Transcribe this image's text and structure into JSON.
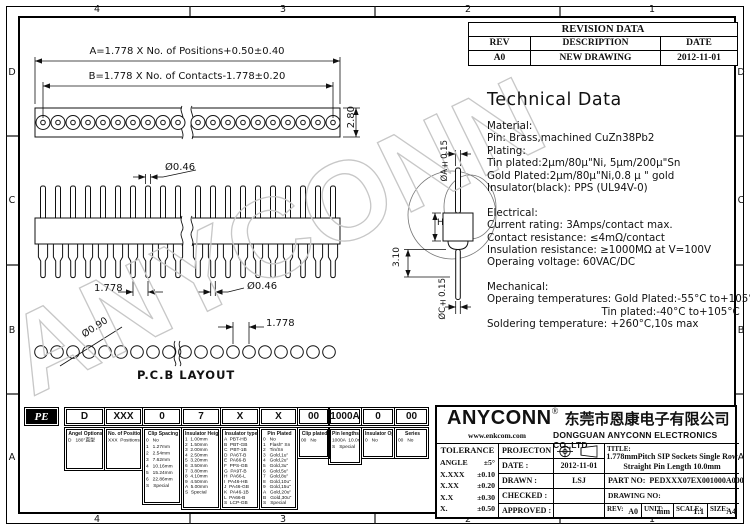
{
  "zones": {
    "cols": [
      "4",
      "3",
      "2",
      "1"
    ],
    "rows": [
      "D",
      "C",
      "B",
      "A"
    ]
  },
  "revision_table": {
    "title": "REVISION DATA",
    "headers": [
      "REV",
      "DESCRIPTION",
      "DATE"
    ],
    "rows": [
      [
        "A0",
        "NEW DRAWING",
        "2012-11-01"
      ]
    ]
  },
  "watermark": {
    "text": "ANYCONN"
  },
  "dims": {
    "a_label": "A=1.778 X No. of Positions+0.50±0.40",
    "b_label": "B=1.778 X No. of Contacts-1.778±0.20",
    "height_280": "2.80",
    "pin_dia_top": "Ø0.46",
    "pitch_side": "1.778",
    "pin_dia_bottom": "Ø0.46",
    "body_h": "H",
    "oa": "ØA±0.15",
    "tail_310": "3.10",
    "oc": "ØC±0.15",
    "hole_dia": "Ø0.90",
    "pitch_pcb": "1.778",
    "pcb_label": "P.C.B LAYOUT"
  },
  "tech": {
    "title": "Technical Data",
    "lines": [
      "Material:",
      "Pin: Brass,machined CuZn38Pb2",
      "Plating:",
      "Tin plated:2μm/80μ\"Ni, 5μm/200μ\"Sn",
      "Gold Plated:2μm/80μ\"Ni,0.8 μ \" gold",
      "Insulator(black): PPS (UL94V-0)",
      "",
      "Electrical:",
      "Current rating: 3Amps/contact max.",
      "Contact resistance: ≤4mΩ/contact",
      "Insulation resistance: ≥1000MΩ at V=100V",
      "Operaing voltage: 60VAC/DC",
      "",
      "Mechanical:",
      "Operaing temperatures: Gold Plated:-55°C to+105°C",
      "                                   Tin plated:-40°C to+105°C",
      "Soldering temperature: +260°C,10s max"
    ]
  },
  "ordering": {
    "prefix": "PE",
    "codes": [
      "D",
      "XXX",
      "0",
      "7",
      "X",
      "X",
      "00",
      "1000A",
      "0",
      "00"
    ],
    "boxes": [
      {
        "title": "Angel Options",
        "rows": [
          "D   180°直型"
        ]
      },
      {
        "title": "No. of Positions",
        "rows": [
          "XXX  Positions"
        ]
      },
      {
        "title": "Clip Spacing",
        "rows": [
          "0   No",
          "1   1.27mm",
          "2   2.54mm",
          "3   7.62mm",
          "4   10.16mm",
          "5   15.24mm",
          "6   22.86mm",
          "S   Special"
        ]
      },
      {
        "title": "Insulator Height",
        "rows": [
          "1  1.00mm",
          "2  1.50mm",
          "3  2.00mm",
          "4  2.50mm",
          "5  3.20mm",
          "6  3.50mm",
          "7  3.80mm",
          "8  4.10mm",
          "9  4.50mm",
          "A  5.00mm",
          "S  Special"
        ]
      },
      {
        "title": "Insulator type",
        "rows": [
          "A  PBT-HB",
          "B  PBT-GB",
          "C  PBT-1B",
          "D  PA6T-B",
          "E  PA66-B",
          "F  PPS-GB",
          "G  PA9T-B",
          "H  PA66-L",
          "I  PA46-HB",
          "J  PA46-GB",
          "K  PA46-1B",
          "L  PA66-B",
          "S  LCP-GB"
        ]
      },
      {
        "title": "Pin Plated",
        "rows": [
          "0   No",
          "1   Flash\" Sn",
          "2   Tin/Sn",
          "3   Gold,1u\"",
          "4   Gold,2u\"",
          "5   Gold,3u\"",
          "6   Gold,5u\"",
          "7   Gold,8u\"",
          "8   Gold,10u\"",
          "9   Gold,15u\"",
          "A   Gold,20u\"",
          "B   Gold,30u\"",
          "S   Special"
        ]
      },
      {
        "title": "Clip plated",
        "rows": [
          "00   No"
        ]
      },
      {
        "title": "Pin lengths(mm)",
        "rows": [
          "1000A  10.0mm",
          "S   Special"
        ]
      },
      {
        "title": "Insulator Option",
        "rows": [
          "0   No"
        ]
      },
      {
        "title": "Series",
        "rows": [
          "00   No"
        ]
      }
    ]
  },
  "company": {
    "logo": "ANYCONN",
    "reg": "®",
    "cn": "东莞市恩康电子有限公司",
    "web": "www.enkcom.com",
    "en": "DONGGUAN  ANYCONN  ELECTRONICS  CO.,LTD"
  },
  "tolerance": {
    "title": "TOLERANCE",
    "rows": [
      [
        "ANGLE",
        "±5°"
      ],
      [
        "X.XXX",
        "±0.10"
      ],
      [
        "X.XX",
        "±0.20"
      ],
      [
        "X.X",
        "±0.30"
      ],
      [
        "X.",
        "±0.50"
      ]
    ]
  },
  "approval": {
    "projection_label": "PROJECTON",
    "rows": [
      {
        "label": "DATE :",
        "value": "2012-11-01"
      },
      {
        "label": "DRAWN :",
        "value": "LSJ"
      },
      {
        "label": "CHECKED :",
        "value": ""
      },
      {
        "label": "APPROVED :",
        "value": ""
      }
    ]
  },
  "title_block": {
    "title_label": "TITLE:",
    "title_line1": "1.778mmPitch SIP Sockets Single Row",
    "title_line2": "Straight Pin Length 10.0mm",
    "part_label": "PART NO:  PEDXXX07EX001000A000",
    "drawing_label": "DRAWING NO:",
    "rev_label": "REV:",
    "rev": "A0",
    "unit_label": "UNIT:",
    "unit": "mm",
    "scale_label": "SCALE:",
    "scale": "1:1",
    "size_label": "SIZE:",
    "size": "A4"
  }
}
